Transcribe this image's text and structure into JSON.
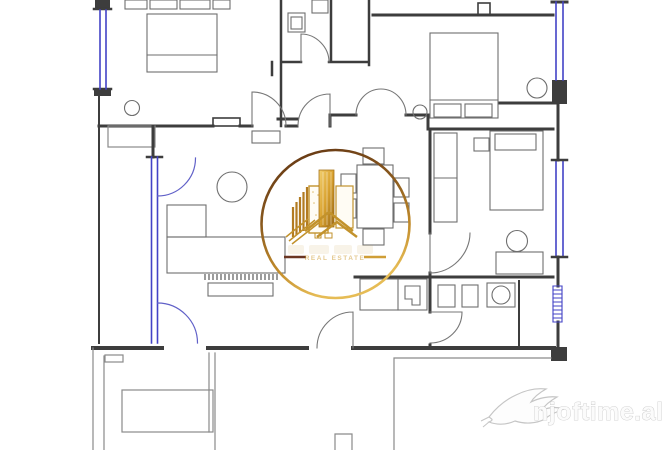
{
  "watermarks": {
    "center_logo": {
      "subtitle": "REAL ESTATE",
      "icon": "gold-buildings-logo",
      "shape": "circle-ring"
    },
    "site": {
      "text": "njoftime.al",
      "icon": "swallow-bird"
    }
  },
  "colors": {
    "background": "#ffffff",
    "wall": "#3d3d3d",
    "furniture_line": "#6e6e6e",
    "thin_outline": "#8a8a8a",
    "window_blue": "#4343c6",
    "door_arc_blue": "#6060c8",
    "logo_gold": "#d9a83c",
    "logo_gold_light": "#f2cf6e",
    "logo_brown": "#6e3b17",
    "logo_maroon": "#6a3522",
    "watermark_gray": "#c9c9c9"
  }
}
